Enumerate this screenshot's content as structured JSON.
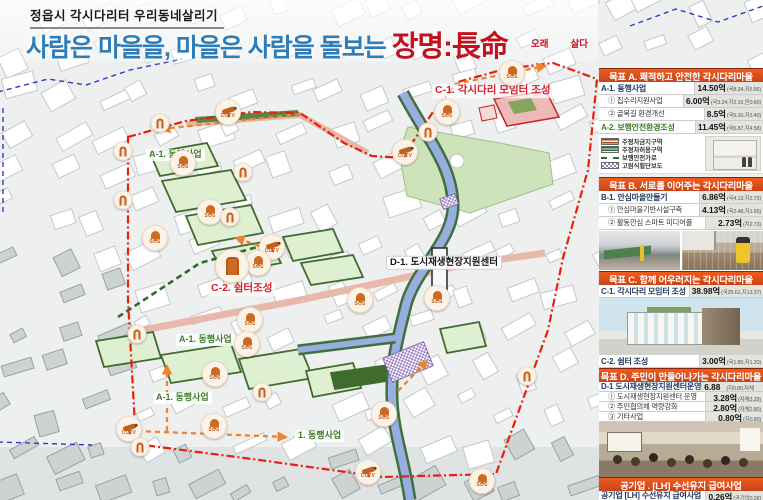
{
  "header": {
    "small_title": "정읍시 각시다리터 우리동네살리기"
  },
  "title": {
    "blue_part": "사람은 마을을, 마을은 사람을 돌보는",
    "red_part": "장명:長命",
    "annotation_left": "오래",
    "annotation_right": "살다"
  },
  "colors": {
    "title_blue": "#2e7cb8",
    "title_red": "#c1121f",
    "header_bar": "#d84a15",
    "label_green": "#3f7d2c",
    "label_red": "#d41f2c",
    "boundary_red": "#e8200a",
    "route_orange": "#ec8430",
    "parcel_green": "#3f6b2f",
    "stream_blue": "#97aede"
  },
  "map": {
    "marker_labels": {
      "cctv": "CCTV",
      "sos": "SOS"
    },
    "labels": [
      {
        "text": "A-1. 동행사업",
        "x": 146,
        "y": 155,
        "style": "green"
      },
      {
        "text": "A-1. 동행사업",
        "x": 176,
        "y": 340,
        "style": "green"
      },
      {
        "text": "A-1. 동행사업",
        "x": 153,
        "y": 398,
        "style": "green"
      },
      {
        "text": "1. 동행사업",
        "x": 295,
        "y": 436,
        "style": "green"
      },
      {
        "text": "C-1. 각시다리 모임터 조성",
        "x": 432,
        "y": 91,
        "style": "red"
      },
      {
        "text": "C-2. 쉼터조성",
        "x": 208,
        "y": 289,
        "style": "red"
      },
      {
        "text": "D-1. 도시재생현장지원센터",
        "x": 386,
        "y": 263,
        "style": "dark"
      }
    ],
    "markers": [
      {
        "type": "cctv",
        "x": 228,
        "y": 112
      },
      {
        "type": "cctv",
        "x": 405,
        "y": 152
      },
      {
        "type": "cctv",
        "x": 272,
        "y": 247
      },
      {
        "type": "cctv",
        "x": 129,
        "y": 429
      },
      {
        "type": "cctv",
        "x": 368,
        "y": 472
      },
      {
        "type": "sos",
        "x": 512,
        "y": 73
      },
      {
        "type": "sos",
        "x": 447,
        "y": 112
      },
      {
        "type": "sos",
        "x": 183,
        "y": 163
      },
      {
        "type": "sos",
        "x": 210,
        "y": 212
      },
      {
        "type": "sos",
        "x": 155,
        "y": 238
      },
      {
        "type": "sos",
        "x": 258,
        "y": 263
      },
      {
        "type": "sos",
        "x": 360,
        "y": 300
      },
      {
        "type": "sos",
        "x": 437,
        "y": 298
      },
      {
        "type": "sos",
        "x": 250,
        "y": 320
      },
      {
        "type": "sos",
        "x": 247,
        "y": 344
      },
      {
        "type": "sos",
        "x": 215,
        "y": 374
      },
      {
        "type": "sos",
        "x": 214,
        "y": 426
      },
      {
        "type": "sos",
        "x": 384,
        "y": 414
      },
      {
        "type": "sos",
        "x": 482,
        "y": 481
      },
      {
        "type": "door",
        "x": 160,
        "y": 123
      },
      {
        "type": "door",
        "x": 123,
        "y": 151
      },
      {
        "type": "door",
        "x": 123,
        "y": 200
      },
      {
        "type": "door",
        "x": 243,
        "y": 172
      },
      {
        "type": "door",
        "x": 230,
        "y": 217
      },
      {
        "type": "door",
        "x": 428,
        "y": 132
      },
      {
        "type": "door",
        "x": 137,
        "y": 334
      },
      {
        "type": "door",
        "x": 262,
        "y": 392
      },
      {
        "type": "door",
        "x": 140,
        "y": 447
      },
      {
        "type": "door",
        "x": 527,
        "y": 376
      },
      {
        "type": "door",
        "x": 232,
        "y": 266,
        "big": true
      }
    ]
  },
  "sidebar": {
    "sections": [
      {
        "id": "A",
        "title": "목표 A. 쾌적하고 안전한 각시다리마을",
        "rows": [
          {
            "label": "A-1. 동행사업",
            "level": "main",
            "amount": "14.50억",
            "detail": "(국8.34,지5.56)"
          },
          {
            "label": "① 집수리지원사업",
            "level": "sub",
            "amount": "6.00억",
            "detail": "(국3.24,지2.16,민0.60)"
          },
          {
            "label": "② 골목길 환경개선",
            "level": "sub",
            "amount": "8.5억",
            "detail": "(국5.10,지3.40)"
          },
          {
            "label": "A-2. 보행안전환경조성",
            "level": "green",
            "amount": "11.45억",
            "detail": "(국6.87,지4.58)"
          }
        ],
        "legend": [
          "주정차금지구역",
          "주정차허용구역",
          "보행안전가로",
          "고원식횡단보도"
        ]
      },
      {
        "id": "B",
        "title": "목표 B. 서로를 이어주는 각시다리마을",
        "rows": [
          {
            "label": "B-1. 안심마을만들기",
            "level": "main",
            "amount": "6.86억",
            "detail": "(국4.13,지2.73)"
          },
          {
            "label": "① 안심마을기반시설구축",
            "level": "sub",
            "amount": "4.13억",
            "detail": "(국2.48,지1.65)"
          },
          {
            "label": "② 활동안심 스마트 미디어폴",
            "level": "sub",
            "amount": "2.73억",
            "detail": "(지2.73)"
          }
        ]
      },
      {
        "id": "C",
        "title": "목표 C. 함께 어우러지는 각시다리마을",
        "rows": [
          {
            "label": "C-1. 각시다리 모임터 조성",
            "level": "main",
            "amount": "38.98억",
            "detail": "(국25.61,지13.37)"
          },
          {
            "label": "C-2. 쉼터 조성",
            "level": "main",
            "amount": "3.00억",
            "detail": "(국1.80,지1.20)"
          }
        ]
      },
      {
        "id": "D",
        "title": "목표 D. 주민이 만들어나가는 각시다리마을",
        "rows": [
          {
            "label": "D-1 도시재생현장지원센터운영",
            "level": "main",
            "amount": "6.88억",
            "detail": "(지0.80,자체6.08)"
          },
          {
            "label": "① 도시재생현장지원센터 운영",
            "level": "sub",
            "amount": "3.28억",
            "detail": "(자체3.28)"
          },
          {
            "label": "② 주민협의체 역량강화",
            "level": "sub",
            "amount": "2.80억",
            "detail": "(자체2.80)"
          },
          {
            "label": "③ 기타사업",
            "level": "sub",
            "amount": "0.80억",
            "detail": "(지0.80)"
          }
        ]
      },
      {
        "id": "LH",
        "title": "공기업 . [LH] 수선유지 급여사업",
        "rows": [
          {
            "label": "공기업 [LH] 수선유지 급여사업",
            "level": "main",
            "amount": "0.26억",
            "detail": "(공기업0.26)"
          }
        ]
      }
    ]
  }
}
